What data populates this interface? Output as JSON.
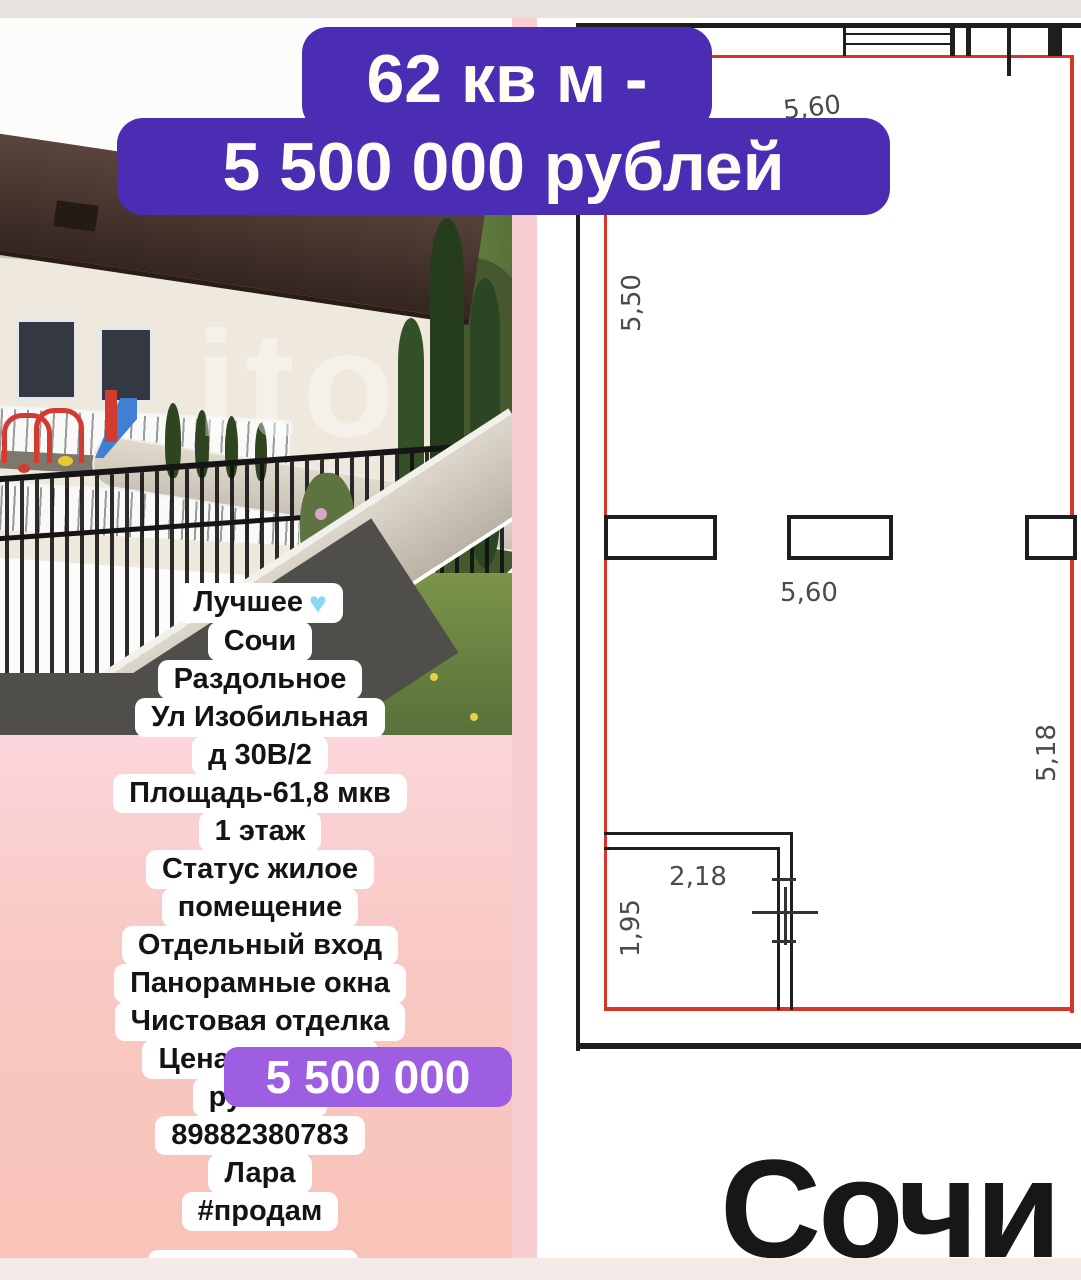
{
  "banner": {
    "line1": "62 кв м -",
    "line2": "5 500 000 рублей"
  },
  "listing": {
    "lines": [
      "Лучшее",
      "Сочи",
      "Раздольное",
      "Ул Изобильная",
      "д 30В/2",
      "Площадь-61,8 мкв",
      "1 этаж",
      "Статус жилое",
      "помещение",
      "Отдельный вход",
      "Панорамные окна",
      "Чистовая отделка",
      "Цена -",
      "рублей",
      "89882380783",
      "Лара",
      "#продам"
    ],
    "heart_icon": "♥"
  },
  "price_sticker": {
    "text": "5 500 000"
  },
  "plan": {
    "dim_top": "5,60",
    "dim_left": "5,50",
    "dim_mid": "5,60",
    "dim_right": "5,18",
    "dim_room_w": "2,18",
    "dim_room_h": "1,95"
  },
  "photo": {
    "watermark": "ito"
  },
  "footer": {
    "city": "Сочи"
  },
  "colors": {
    "banner_purple": "#4b2db4",
    "sticker_purple": "#9e5ee2",
    "plan_red": "#d6352a",
    "pink_bg": "#f9c9c4"
  }
}
